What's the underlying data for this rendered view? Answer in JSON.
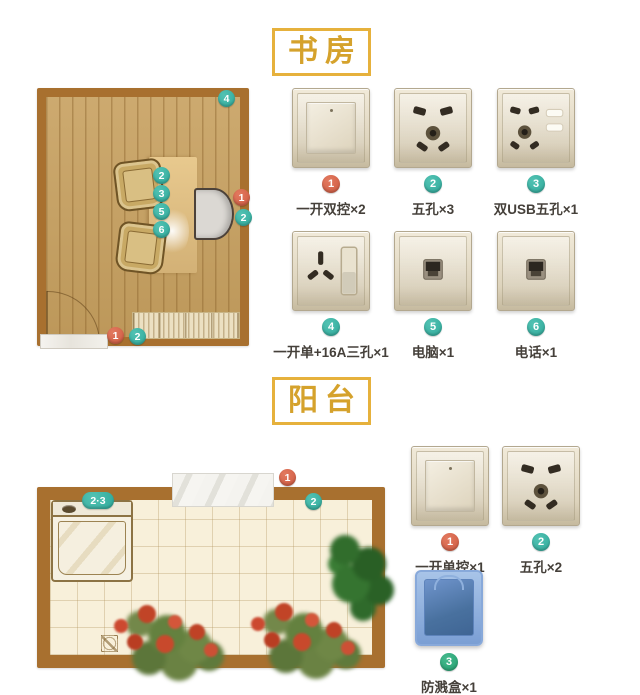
{
  "study": {
    "title": "书房",
    "plan": {
      "markers": [
        {
          "label": "4"
        },
        {
          "label": "2"
        },
        {
          "label": "3"
        },
        {
          "label": "5"
        },
        {
          "label": "6"
        },
        {
          "label": "1"
        },
        {
          "label": "2"
        },
        {
          "label": "1"
        },
        {
          "label": "2"
        }
      ]
    },
    "products": [
      {
        "num": "1",
        "label": "一开双控×2"
      },
      {
        "num": "2",
        "label": "五孔×3"
      },
      {
        "num": "3",
        "label": "双USB五孔×1"
      },
      {
        "num": "4",
        "label": "一开单+16A三孔×1"
      },
      {
        "num": "5",
        "label": "电脑×1"
      },
      {
        "num": "6",
        "label": "电话×1"
      }
    ]
  },
  "balcony": {
    "title": "阳台",
    "plan": {
      "markers": [
        {
          "label": "2·3"
        },
        {
          "label": "1"
        },
        {
          "label": "2"
        }
      ]
    },
    "products": [
      {
        "num": "1",
        "label": "一开单控×1"
      },
      {
        "num": "2",
        "label": "五孔×2"
      },
      {
        "num": "3",
        "label": "防溅盒×1"
      }
    ]
  },
  "colors": {
    "accent_gold": "#d5a22c",
    "badge_orange": "#cf5a41",
    "badge_teal": "#2fa99a",
    "badge_green": "#23a070",
    "splash_blue": "#5b87c6",
    "wall_brown": "#a8702f"
  }
}
